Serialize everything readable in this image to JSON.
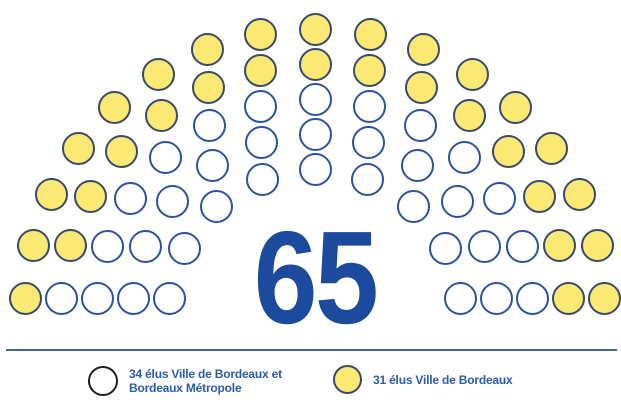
{
  "chart_data": {
    "type": "parliament",
    "title": "Répartition des 65 élus du conseil",
    "total_seats": 65,
    "center_label": "65",
    "rows": [
      9,
      11,
      13,
      15,
      17
    ],
    "row_colors": [
      [
        "white",
        "white",
        "white",
        "white",
        "white",
        "white",
        "white",
        "white",
        "white"
      ],
      [
        "white",
        "white",
        "white",
        "white",
        "white",
        "white",
        "white",
        "white",
        "white",
        "white",
        "white"
      ],
      [
        "white",
        "white",
        "white",
        "white",
        "white",
        "white",
        "white",
        "white",
        "white",
        "white",
        "white",
        "white",
        "white"
      ],
      [
        "white",
        "yellow",
        "yellow",
        "yellow",
        "yellow",
        "yellow",
        "yellow",
        "yellow",
        "yellow",
        "yellow",
        "yellow",
        "yellow",
        "yellow",
        "yellow",
        "yellow"
      ],
      [
        "yellow",
        "yellow",
        "yellow",
        "yellow",
        "yellow",
        "yellow",
        "yellow",
        "yellow",
        "yellow",
        "yellow",
        "yellow",
        "yellow",
        "yellow",
        "yellow",
        "yellow",
        "yellow",
        "yellow"
      ]
    ],
    "series": [
      {
        "name": "34 élus Ville de Bordeaux et Bordeaux Métropole",
        "seats": 34,
        "fill": "#FFFFFF",
        "border": "#2C52A2"
      },
      {
        "name": "31 élus Ville de Bordeaux",
        "seats": 31,
        "fill": "#FBE974",
        "border": "#364A6C"
      }
    ],
    "legend_position": "bottom"
  },
  "legend": {
    "items": [
      {
        "swatch": "white",
        "lines": [
          "34 élus Ville de Bordeaux et",
          "Bordeaux Métropole"
        ]
      },
      {
        "swatch": "yellow",
        "lines": [
          "31 élus Ville de Bordeaux"
        ]
      }
    ]
  },
  "colors": {
    "seat_yellow_fill": "#FBE974",
    "seat_yellow_border": "#364A6C",
    "seat_white_border": "#2C52A2",
    "total_number": "#1C4A9C",
    "legend_text": "#2B5CAB",
    "divider": "#476394",
    "background": "#FFFFFF"
  }
}
